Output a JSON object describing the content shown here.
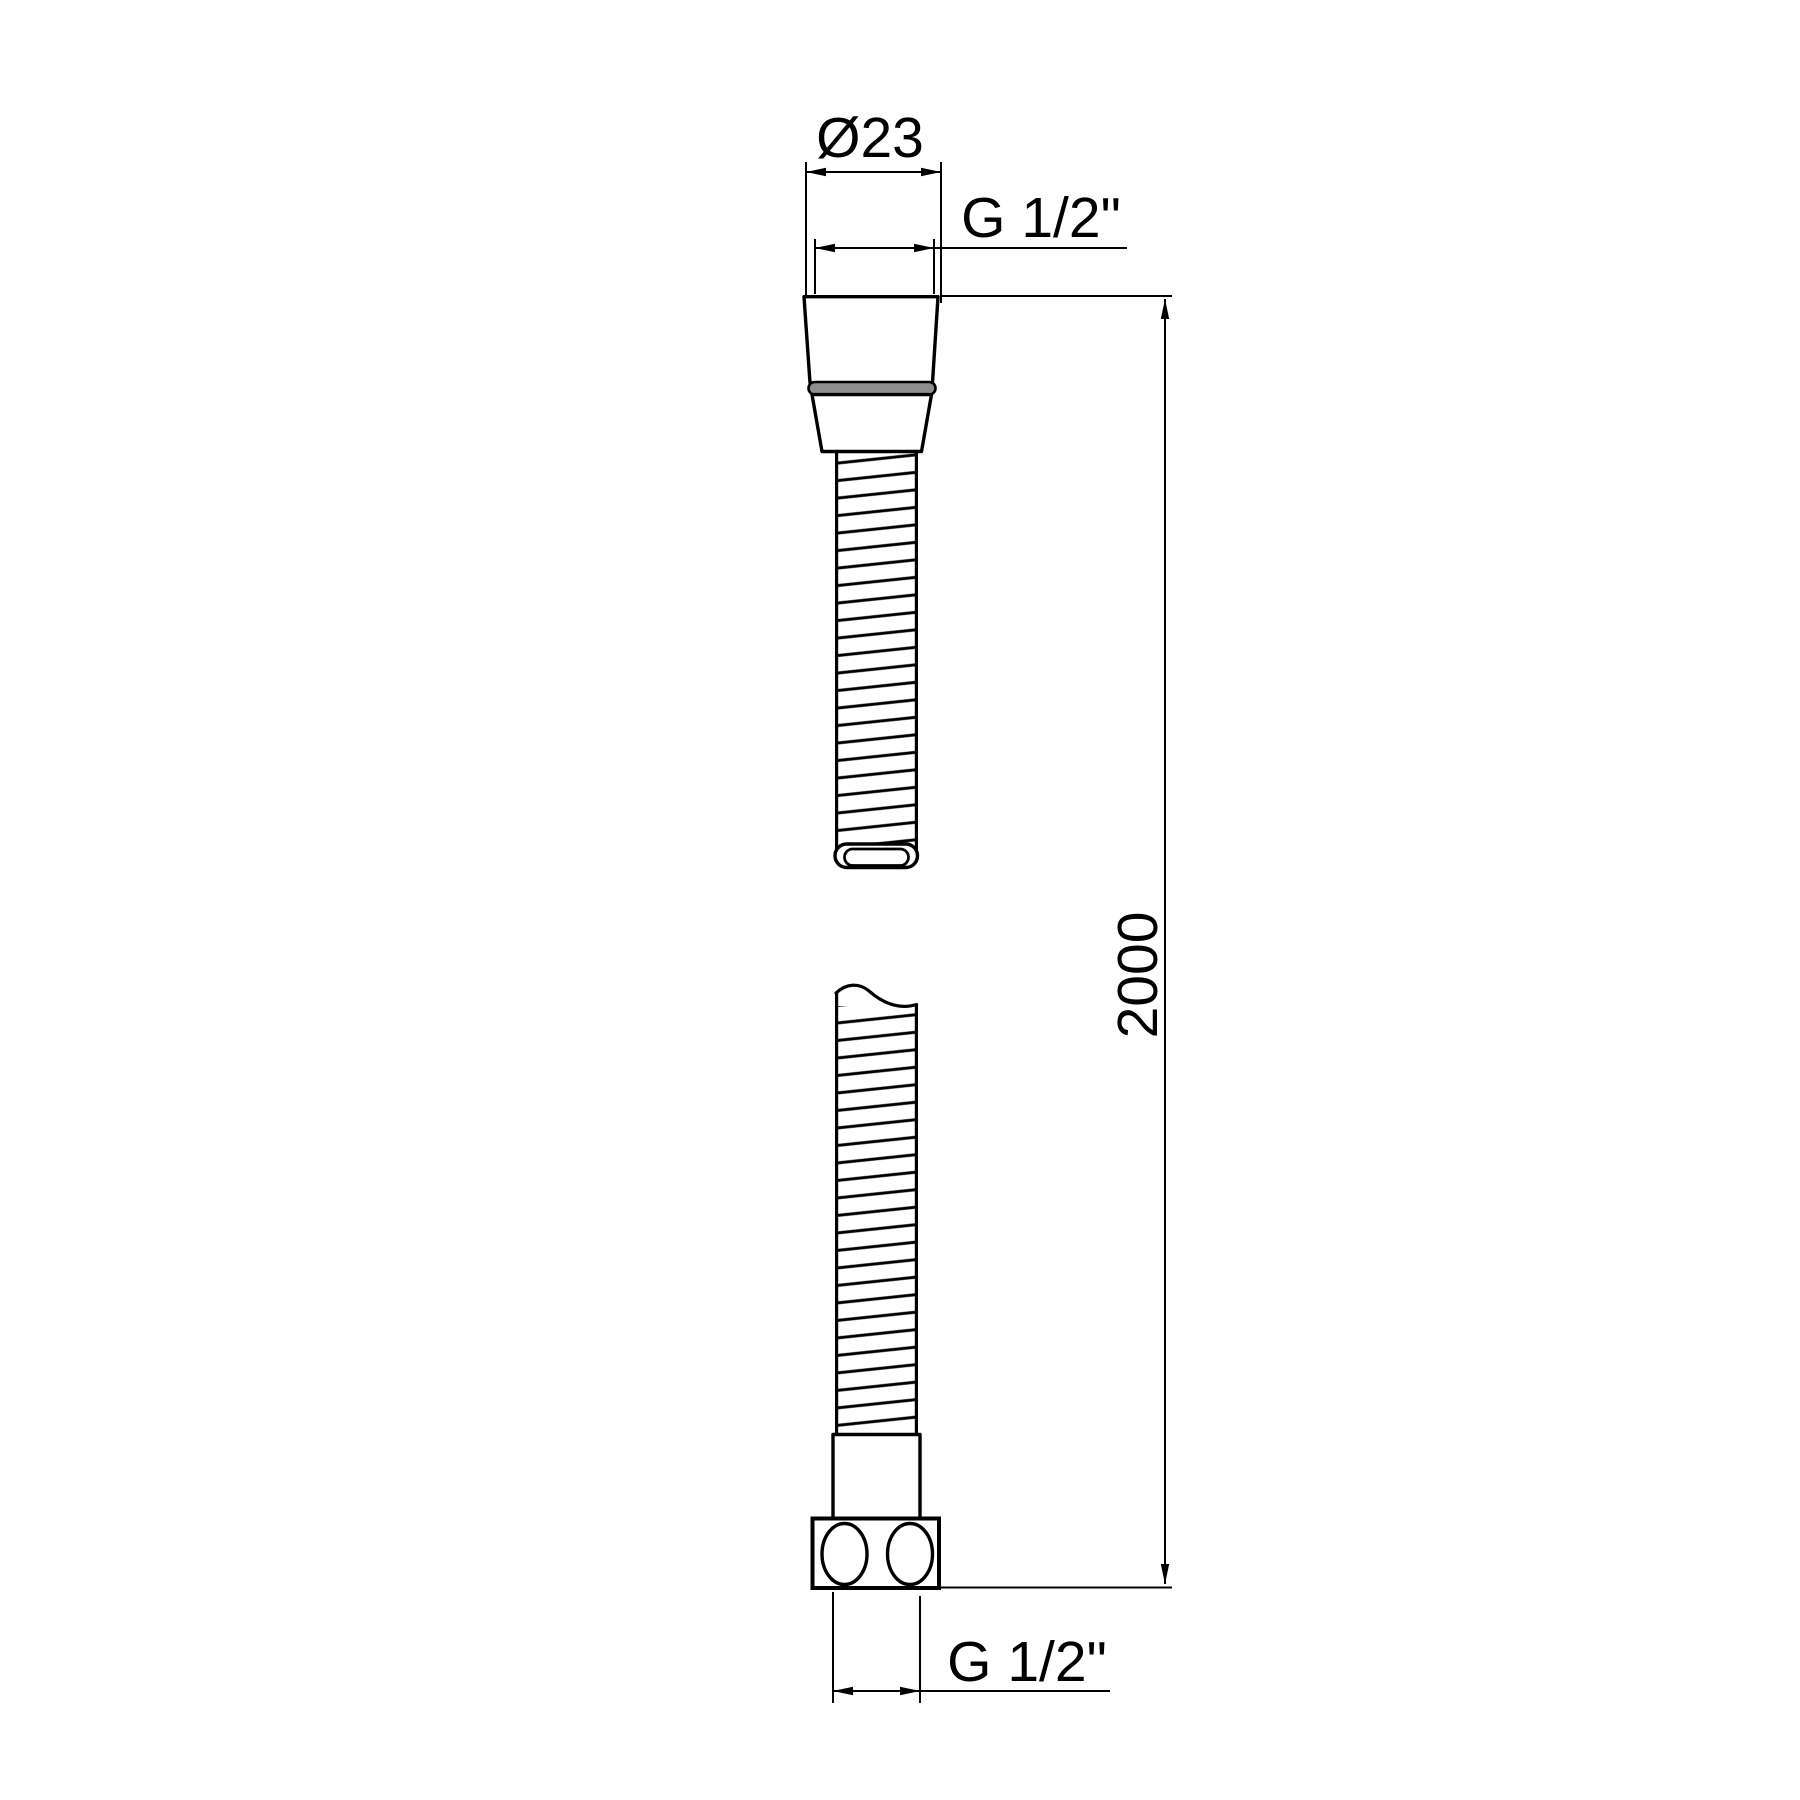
{
  "drawing": {
    "labels": {
      "diameter_top": "Ø23",
      "thread_top": "G 1/2\"",
      "length": "2000",
      "thread_bottom": "G 1/2\""
    },
    "colors": {
      "line": "#000000",
      "gasket": "#8f8f8f",
      "background": "#ffffff"
    }
  }
}
